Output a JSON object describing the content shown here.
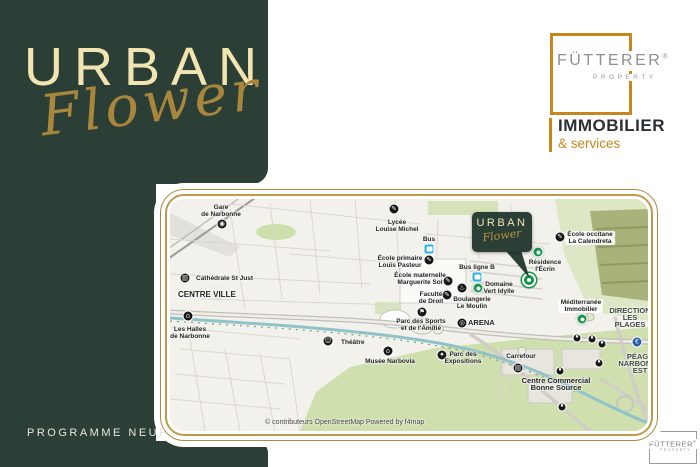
{
  "brand": {
    "title": "URBAN",
    "subtitle": "Flower",
    "footer": "PROGRAMME NEUF"
  },
  "logo": {
    "name": "FÜTTERER",
    "reg": "®",
    "property": "PROPERTY",
    "line1": "IMMOBILIER",
    "line2": "& services"
  },
  "logo_small": {
    "name": "FÜTTERER",
    "reg": "®",
    "property": "PROPERTY"
  },
  "colors": {
    "brand_green": "#2c3f36",
    "brand_cream": "#f3e5b2",
    "brand_gold": "#a8873c",
    "frame_gold": "#c09a4b",
    "logo_orange": "#c8871d",
    "poi_black": "#161616",
    "poi_bus_cyan": "#27b2e2",
    "poi_green": "#11964a",
    "poi_blue": "#2d5da6"
  },
  "map": {
    "attribution": "© contributeurs OpenStreetMap  Powered by f4map",
    "callout": {
      "title": "URBAN",
      "subtitle": "Flower"
    },
    "pois": [
      {
        "id": "gare-de-narbonne",
        "icon": {
          "kind": "black",
          "glyph": "◉",
          "x": 52,
          "y": 25
        },
        "label": {
          "lines": [
            "Gare",
            "de Narbonne"
          ],
          "x": 51,
          "y": 5
        }
      },
      {
        "id": "cathedrale-st-just",
        "icon": {
          "kind": "black",
          "glyph": "▥",
          "x": 15,
          "y": 79
        },
        "label": {
          "lines": [
            "Cathédrale St Just"
          ],
          "x": 26,
          "y": 76,
          "align": "left"
        }
      },
      {
        "id": "centre-ville",
        "label": {
          "lines": [
            "CENTRE VILLE"
          ],
          "x": 8,
          "y": 92,
          "align": "left",
          "size": 8
        }
      },
      {
        "id": "les-halles-de-narbonne",
        "icon": {
          "kind": "black",
          "glyph": "⌂",
          "x": 18,
          "y": 117
        },
        "label": {
          "lines": [
            "Les Halles",
            "de Narbonne"
          ],
          "x": 20,
          "y": 127
        }
      },
      {
        "id": "theatre",
        "icon": {
          "kind": "black",
          "glyph": "☺",
          "x": 158,
          "y": 142
        },
        "label": {
          "lines": [
            "Théâtre"
          ],
          "x": 171,
          "y": 140,
          "align": "left"
        }
      },
      {
        "id": "musee-narbovia",
        "icon": {
          "kind": "black",
          "glyph": "⌂",
          "x": 218,
          "y": 152
        },
        "label": {
          "lines": [
            "Musée Narbovia"
          ],
          "x": 220,
          "y": 159
        }
      },
      {
        "id": "lycee-louise-michel",
        "icon": {
          "kind": "black",
          "glyph": "✎",
          "x": 224,
          "y": 10
        },
        "label": {
          "lines": [
            "Lycée",
            "Louise Michel"
          ],
          "x": 227,
          "y": 20
        }
      },
      {
        "id": "bus",
        "icon": {
          "kind": "bus",
          "x": 259,
          "y": 50
        },
        "label": {
          "lines": [
            "Bus"
          ],
          "x": 259,
          "y": 37
        }
      },
      {
        "id": "ecole-primaire-louis-pasteur",
        "icon": {
          "kind": "black",
          "glyph": "✎",
          "x": 259,
          "y": 61
        },
        "label": {
          "lines": [
            "École primaire",
            "Louis Pasteur"
          ],
          "x": 230,
          "y": 56
        }
      },
      {
        "id": "bus-ligne-b",
        "icon": {
          "kind": "bus",
          "x": 307,
          "y": 78
        },
        "label": {
          "lines": [
            "Bus ligne B"
          ],
          "x": 307,
          "y": 65
        }
      },
      {
        "id": "ecole-maternelle-marguerite-sol",
        "icon": {
          "kind": "black",
          "glyph": "✎",
          "x": 278,
          "y": 82
        },
        "label": {
          "lines": [
            "École maternelle",
            "Marguerite Sol"
          ],
          "x": 250,
          "y": 73
        }
      },
      {
        "id": "faculte-de-droit",
        "icon": {
          "kind": "black",
          "glyph": "✎",
          "x": 277,
          "y": 96
        },
        "label": {
          "lines": [
            "Faculté",
            "de Droit"
          ],
          "x": 261,
          "y": 92
        }
      },
      {
        "id": "boulangerie-le-moulin",
        "icon": {
          "kind": "black",
          "glyph": "♨",
          "x": 292,
          "y": 89
        },
        "label": {
          "lines": [
            "Boulangerie",
            "Le Moulin"
          ],
          "x": 302,
          "y": 97
        }
      },
      {
        "id": "domaine-vert-idylle",
        "icon": {
          "kind": "green",
          "x": 308,
          "y": 89
        },
        "label": {
          "lines": [
            "Domaine",
            "Vert Idylle"
          ],
          "x": 329,
          "y": 82
        }
      },
      {
        "id": "urban-flower-marker",
        "icon": {
          "kind": "target",
          "x": 359,
          "y": 81
        }
      },
      {
        "id": "residence-l-ecrin",
        "icon": {
          "kind": "green",
          "x": 368,
          "y": 53
        },
        "label": {
          "lines": [
            "Résidence",
            "l'Écrin"
          ],
          "x": 375,
          "y": 60
        }
      },
      {
        "id": "ecole-occitane-la-calendreta",
        "icon": {
          "kind": "black",
          "glyph": "✎",
          "x": 390,
          "y": 38
        },
        "label": {
          "lines": [
            "École occitane",
            "La Calendreta"
          ],
          "x": 420,
          "y": 32,
          "pill": true
        }
      },
      {
        "id": "mediterranee-immobilier",
        "icon": {
          "kind": "green",
          "x": 412,
          "y": 120
        },
        "label": {
          "lines": [
            "Méditerranée",
            "Immobilier"
          ],
          "x": 411,
          "y": 100,
          "pill": true
        }
      },
      {
        "id": "parc-des-sports",
        "icon": {
          "kind": "black",
          "glyph": "⚑",
          "x": 252,
          "y": 113
        },
        "label": {
          "lines": [
            "Parc des Sports",
            "et de l'Amitié"
          ],
          "x": 251,
          "y": 119
        }
      },
      {
        "id": "arena",
        "icon": {
          "kind": "black",
          "glyph": "◎",
          "x": 292,
          "y": 124
        },
        "label": {
          "lines": [
            "ARENA"
          ],
          "x": 298,
          "y": 120,
          "align": "left",
          "size": 7.5
        }
      },
      {
        "id": "parc-des-expositions",
        "icon": {
          "kind": "black",
          "glyph": "✦",
          "x": 272,
          "y": 156
        },
        "label": {
          "lines": [
            "Parc des",
            "Expositions"
          ],
          "x": 293,
          "y": 152
        }
      },
      {
        "id": "carrefour",
        "icon": {
          "kind": "black",
          "glyph": "▤",
          "x": 348,
          "y": 169
        },
        "label": {
          "lines": [
            "Carrefour"
          ],
          "x": 351,
          "y": 154
        }
      },
      {
        "id": "centre-commercial-bonne-source",
        "label": {
          "lines": [
            "Centre Commercial",
            "Bonne Source"
          ],
          "x": 386,
          "y": 178,
          "size": 7.5
        }
      },
      {
        "id": "direction-les-plages",
        "label": {
          "lines": [
            "DIRECTION",
            "LES",
            "PLAGES"
          ],
          "x": 460,
          "y": 108,
          "size": 7.5,
          "color": "#3c4a42"
        }
      },
      {
        "id": "peage-narbonne-est",
        "icon": {
          "kind": "blue",
          "glyph": "€",
          "x": 467,
          "y": 143
        },
        "label": {
          "lines": [
            "PÉAGE",
            "NARBONNE",
            "EST"
          ],
          "x": 470,
          "y": 154,
          "size": 7.5,
          "color": "#3c4a42"
        }
      },
      {
        "id": "shop-poi-1",
        "icon": {
          "kind": "dot",
          "glyph": "▪",
          "x": 407,
          "y": 139
        }
      },
      {
        "id": "shop-poi-2",
        "icon": {
          "kind": "dot",
          "glyph": "▪",
          "x": 422,
          "y": 140
        }
      },
      {
        "id": "shop-poi-3",
        "icon": {
          "kind": "dot",
          "glyph": "▪",
          "x": 432,
          "y": 145
        }
      },
      {
        "id": "shop-poi-4",
        "icon": {
          "kind": "dot",
          "glyph": "▪",
          "x": 429,
          "y": 164
        }
      },
      {
        "id": "shop-poi-5",
        "icon": {
          "kind": "dot",
          "glyph": "▪",
          "x": 390,
          "y": 172
        }
      },
      {
        "id": "shop-poi-6",
        "icon": {
          "kind": "dot",
          "glyph": "▪",
          "x": 392,
          "y": 208
        }
      }
    ]
  }
}
